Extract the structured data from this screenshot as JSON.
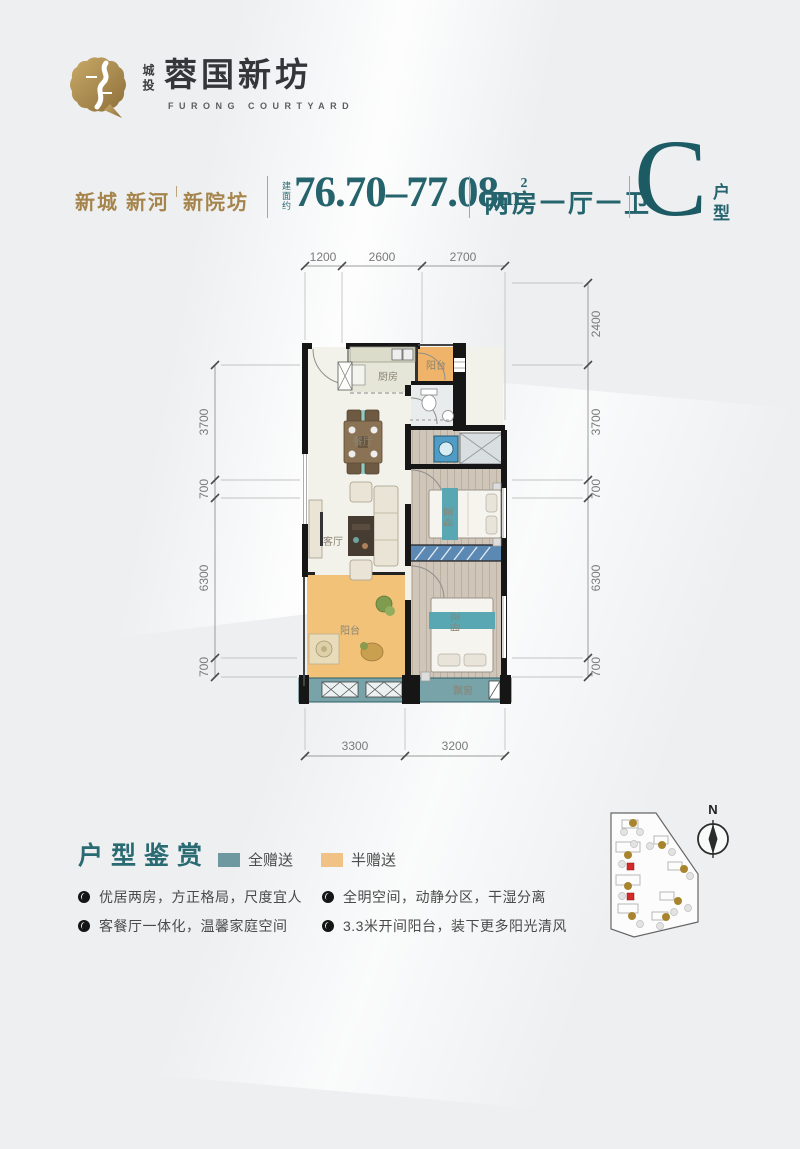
{
  "colors": {
    "teal": "#26646e",
    "teal_dark": "#1c5a64",
    "gold": "#a6854c",
    "orange_half": "#efb369",
    "yellow_half": "#f1c285",
    "teal_full": "#6e99a1",
    "red_marker": "#d42a2a"
  },
  "logo": {
    "brand_cn_small": "城投",
    "brand_cn": "蓉国新坊",
    "brand_en": "FURONG COURTYARD"
  },
  "header": {
    "location_a": "新城 新河",
    "location_b": "新院坊",
    "area_label": "建面约",
    "area_value": "76.70–77.08",
    "area_unit": "m",
    "area_exp": "2",
    "layout": "两房一厅一卫",
    "unit": "C",
    "unit_suffix": "户型"
  },
  "plan": {
    "dims_top": [
      "1200",
      "2600",
      "2700"
    ],
    "dims_left": [
      "3700",
      "700",
      "6300",
      "700"
    ],
    "dims_right": [
      "2400",
      "3700",
      "700",
      "6300",
      "700"
    ],
    "dims_bottom": [
      "3300",
      "3200"
    ],
    "labels": {
      "kitchen": "厨房",
      "balcony_top": "阳台",
      "dining": "餐厅",
      "living": "客厅",
      "bedroom_1": "卧室",
      "bedroom_2": "卧室",
      "balcony_bottom": "阳台",
      "bay_window": "飘窗"
    }
  },
  "footer": {
    "title": "户型鉴赏",
    "legend_full": "全赠送",
    "legend_half": "半赠送",
    "features": [
      "优居两房，方正格局，尺度宜人",
      "全明空间，动静分区，干湿分离",
      "客餐厅一体化，温馨家庭空间",
      "3.3米开间阳台，装下更多阳光清风"
    ]
  },
  "compass": {
    "north": "N"
  }
}
